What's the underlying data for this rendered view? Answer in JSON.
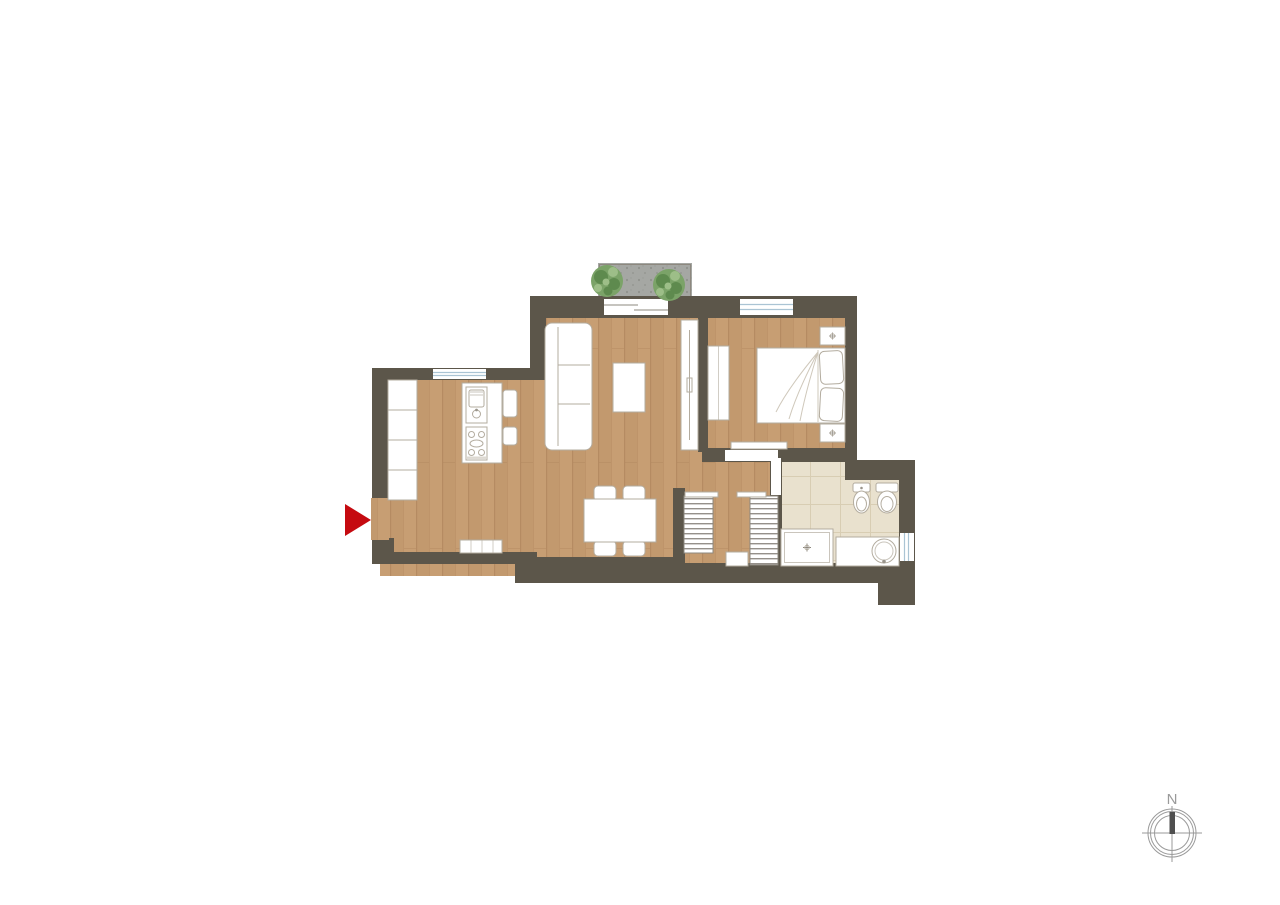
{
  "compass": {
    "label": "N"
  },
  "floor_plan": {
    "entrance": {
      "marker": "red-arrow",
      "side": "west"
    },
    "rooms": [
      {
        "name": "kitchen",
        "furniture": [
          "wall-cabinets",
          "island-sink",
          "cooktop",
          "bar-stools",
          "radiator"
        ]
      },
      {
        "name": "living-dining-room",
        "furniture": [
          "sofa",
          "coffee-table",
          "dining-table",
          "four-chairs"
        ]
      },
      {
        "name": "bedroom",
        "furniture": [
          "double-bed",
          "two-pillows",
          "wardrobe",
          "two-nightstands"
        ]
      },
      {
        "name": "hallway",
        "furniture": [
          "louvered-closet-left",
          "louvered-closet-right",
          "cabinet"
        ]
      },
      {
        "name": "bathroom",
        "furniture": [
          "bidet",
          "toilet",
          "shower-tray",
          "washbasin-counter"
        ]
      },
      {
        "name": "balcony",
        "furniture": [
          "plant-left",
          "plant-right"
        ]
      }
    ],
    "doors": [
      "entrance-door",
      "balcony-sliding-door",
      "bedroom-pocket-door",
      "bedroom-sliding-door",
      "bathroom-door"
    ],
    "windows": [
      "kitchen-window-north",
      "bedroom-window-north",
      "bathroom-window-east"
    ]
  },
  "colors": {
    "wall": "#5c564a",
    "wood": "#c79e73",
    "wood_dark": "#bc9268",
    "wood_line": "#aa8058",
    "tile": "#e9e1ce",
    "tile_line": "#d8cdb3",
    "balcony": "#a5a7a3",
    "balcony_dot": "#90928d",
    "furniture_line": "#b3ac9f",
    "window_glass": "#aac4d4",
    "plant": "#7ba368",
    "plant_dark": "#5e8a4e",
    "plant_light": "#9dbe88",
    "sketch": "#cfc8bb",
    "arrow": "#c50a10",
    "compass": "#9a9a9a",
    "needle": "#4f4f4f"
  }
}
